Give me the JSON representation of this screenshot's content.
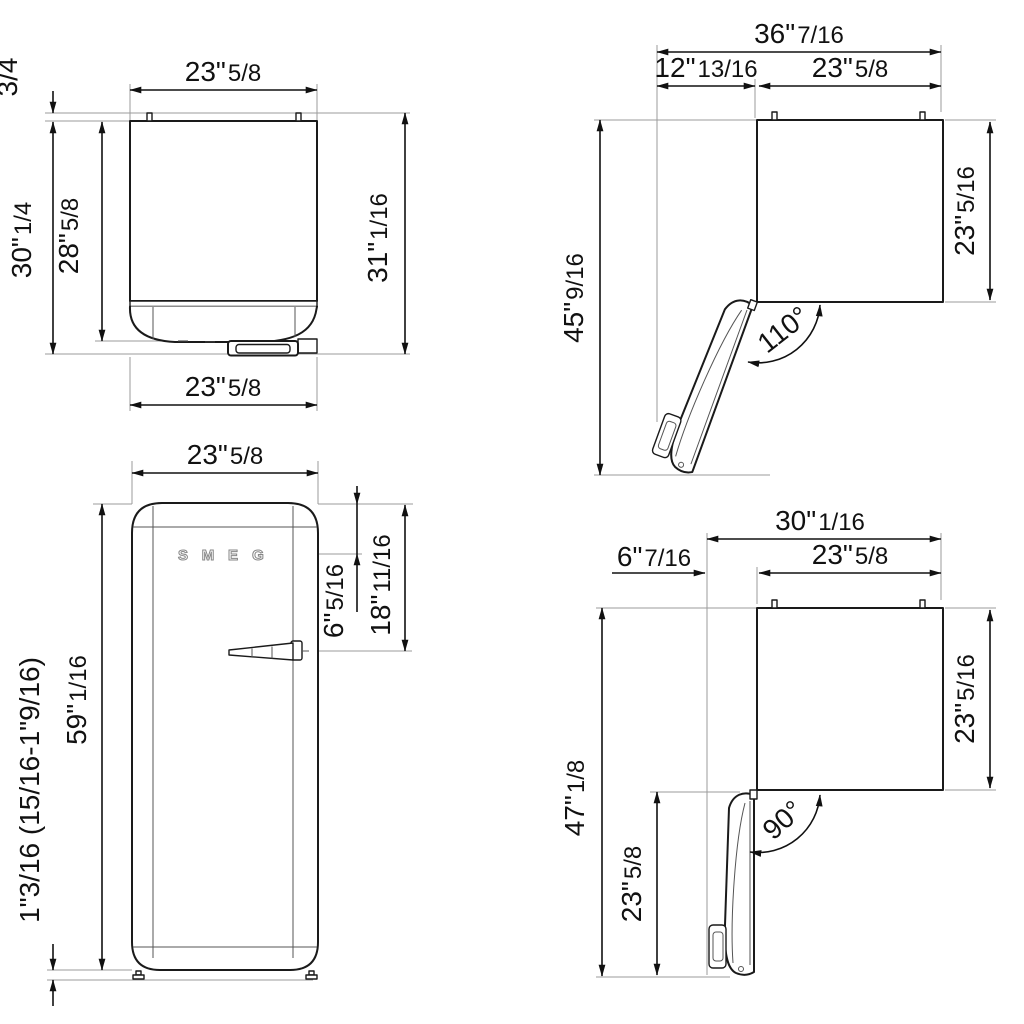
{
  "background": "#ffffff",
  "line_colors": {
    "object": "#1a1a1a",
    "dimension": "#111111",
    "extension": "#9b9b9b"
  },
  "back_view": {
    "top_width": {
      "w": "23\"",
      "f": "5/8"
    },
    "hinge_pin_height": {
      "w": "3/4",
      "f": ""
    },
    "body_height": {
      "w": "30\"",
      "f": "1/4"
    },
    "cabinet_height": {
      "w": "28\"",
      "f": "5/8"
    },
    "total_height": {
      "w": "31\"",
      "f": "1/16"
    },
    "bottom_width": {
      "w": "23\"",
      "f": "5/8"
    }
  },
  "front_view": {
    "top_width": {
      "w": "23\"",
      "f": "5/8"
    },
    "height": {
      "w": "59\"",
      "f": "1/16"
    },
    "feet_height": {
      "w": "1\"3/16 (15/16-1\"9/16)",
      "f": ""
    },
    "logo_offset": {
      "w": "6\"",
      "f": "5/16"
    },
    "handle_offset": {
      "w": "18\"",
      "f": "11/16"
    },
    "logo": {
      "letters": [
        "S",
        "M",
        "E",
        "G"
      ]
    }
  },
  "door_110_view": {
    "overall_width": {
      "w": "36\"",
      "f": "7/16"
    },
    "door_projection": {
      "w": "12\"",
      "f": "13/16"
    },
    "cabinet_width": {
      "w": "23\"",
      "f": "5/8"
    },
    "overall_depth": {
      "w": "45\"",
      "f": "9/16"
    },
    "cabinet_depth": {
      "w": "23\"",
      "f": "5/16"
    },
    "door_angle": "110°"
  },
  "door_90_view": {
    "overall_width": {
      "w": "30\"",
      "f": "1/16"
    },
    "door_projection": {
      "w": "6\"",
      "f": "7/16"
    },
    "cabinet_width": {
      "w": "23\"",
      "f": "5/8"
    },
    "overall_depth": {
      "w": "47\"",
      "f": "1/8"
    },
    "cabinet_depth": {
      "w": "23\"",
      "f": "5/16"
    },
    "door_length": {
      "w": "23\"",
      "f": "5/8"
    },
    "door_angle": "90°"
  }
}
